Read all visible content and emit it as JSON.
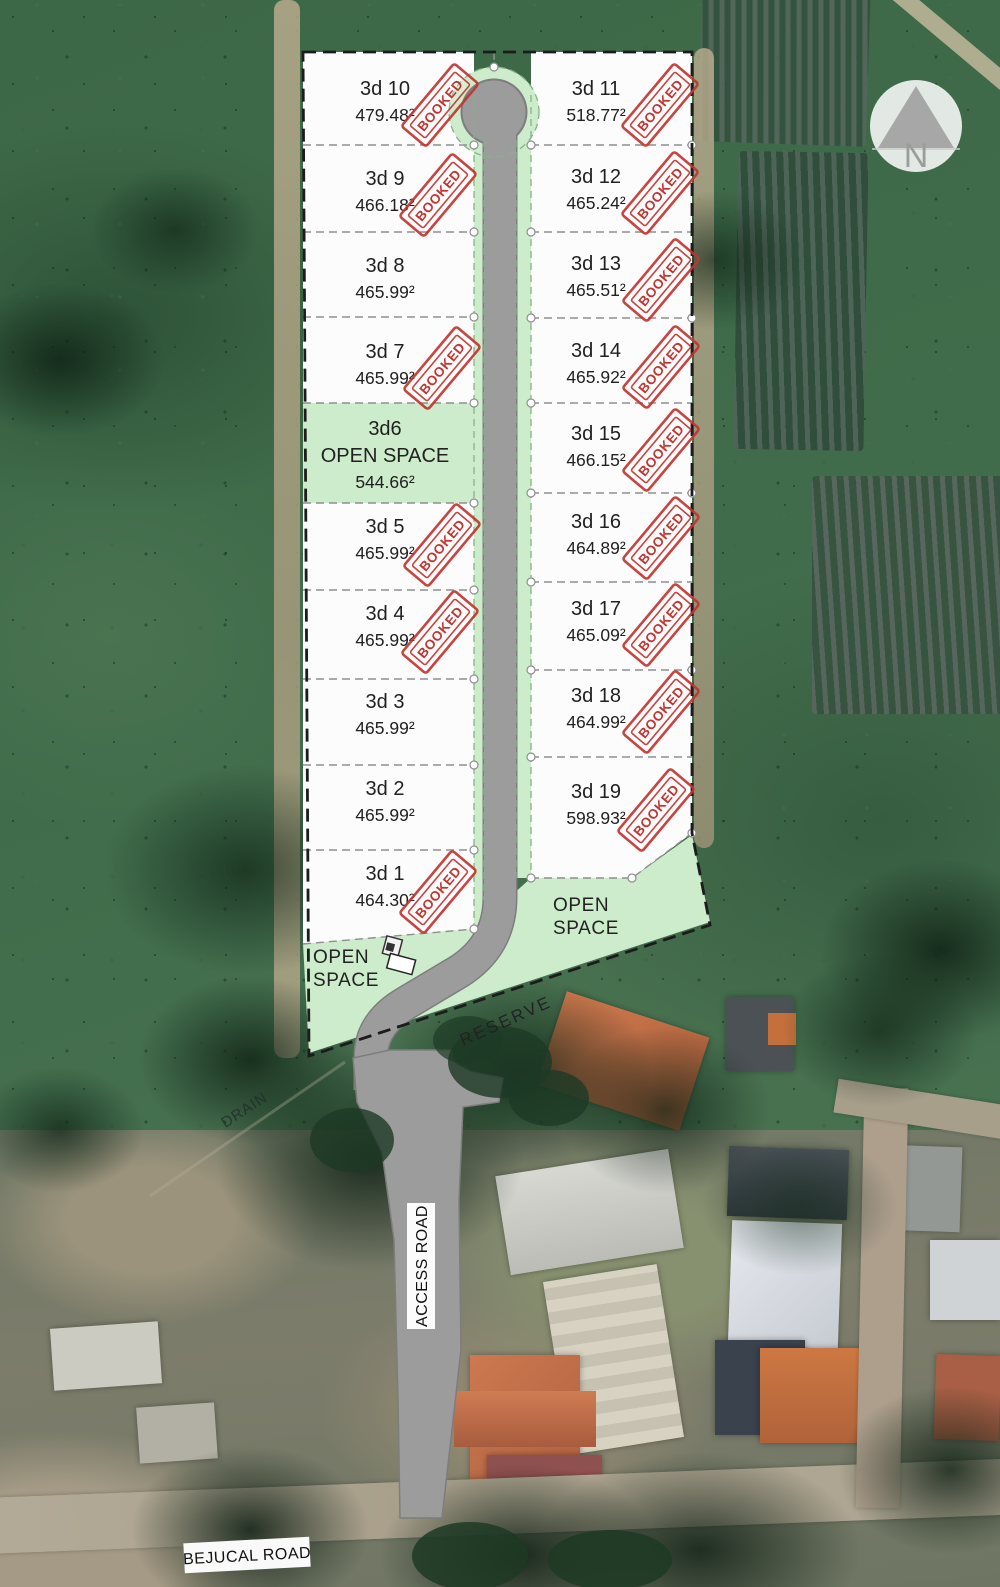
{
  "plan": {
    "compass_label": "N",
    "stamp_label": "BOOKED",
    "left_lots": [
      {
        "name": "3d 10",
        "area": "479.48²",
        "booked": true
      },
      {
        "name": "3d 9",
        "area": "466.18²",
        "booked": true
      },
      {
        "name": "3d 8",
        "area": "465.99²",
        "booked": false
      },
      {
        "name": "3d 7",
        "area": "465.99²",
        "booked": true
      },
      {
        "name": "3d6",
        "line2": "OPEN SPACE",
        "area": "544.66²",
        "booked": false,
        "open_space": true
      },
      {
        "name": "3d 5",
        "area": "465.99²",
        "booked": true
      },
      {
        "name": "3d 4",
        "area": "465.99²",
        "booked": true
      },
      {
        "name": "3d 3",
        "area": "465.99²",
        "booked": false
      },
      {
        "name": "3d 2",
        "area": "465.99²",
        "booked": false
      },
      {
        "name": "3d 1",
        "area": "464.30²",
        "booked": true
      }
    ],
    "right_lots": [
      {
        "name": "3d 11",
        "area": "518.77²",
        "booked": true
      },
      {
        "name": "3d 12",
        "area": "465.24²",
        "booked": true
      },
      {
        "name": "3d 13",
        "area": "465.51²",
        "booked": true
      },
      {
        "name": "3d 14",
        "area": "465.92²",
        "booked": true
      },
      {
        "name": "3d 15",
        "area": "466.15²",
        "booked": true
      },
      {
        "name": "3d 16",
        "area": "464.89²",
        "booked": true
      },
      {
        "name": "3d 17",
        "area": "465.09²",
        "booked": true
      },
      {
        "name": "3d 18",
        "area": "464.99²",
        "booked": true
      },
      {
        "name": "3d 19",
        "area": "598.93²",
        "booked": true
      }
    ],
    "open_space_left": {
      "line1": "OPEN",
      "line2": "SPACE"
    },
    "open_space_right": {
      "line1": "OPEN",
      "line2": "SPACE"
    },
    "reserve_label": "RESERVE",
    "drain_label": "DRAIN",
    "access_road_label": "ACCESS ROAD",
    "bejucal_road_label": "BEJUCAL ROAD"
  },
  "colors": {
    "lot_fill": "#fcfcfc",
    "open_space_green": "#cdeccb",
    "road_gray": "#9c9c9c",
    "stamp_red": "#c23430",
    "boundary_black": "#1c1c1c",
    "divider_gray": "#8f8f8f"
  }
}
